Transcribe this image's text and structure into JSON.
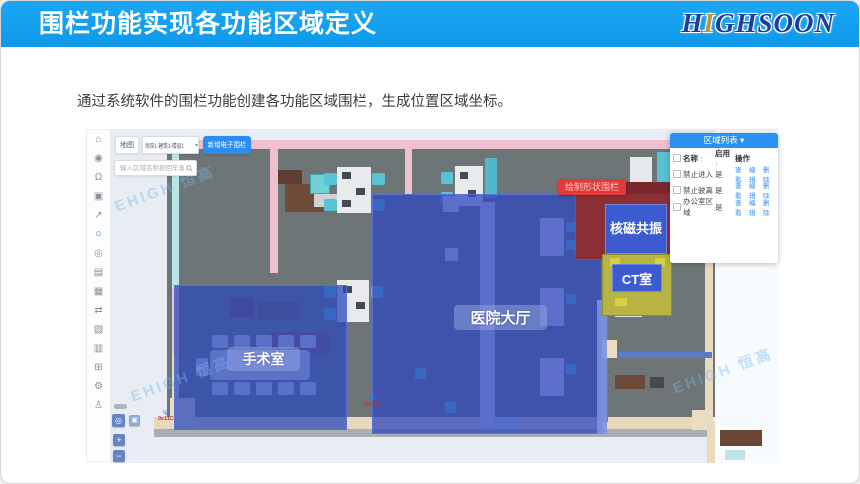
{
  "slide": {
    "title": "围栏功能实现各功能区域定义",
    "logo": {
      "part1": "H",
      "part2": "I",
      "part3": "GHSOON"
    },
    "body_text": "通过系统软件的围栏功能创建各功能区域围栏，生成位置区域坐标。"
  },
  "app": {
    "toolbar": {
      "map_label": "地图",
      "floor_selector": "场馆1-建筑1-楼层1",
      "caret": "▾",
      "add_fence_button": "新增电子围栏",
      "search_placeholder": "输入区域名称按回车查找"
    },
    "sidebar_icons": [
      {
        "name": "home-icon",
        "glyph": "⌂"
      },
      {
        "name": "eye-icon",
        "glyph": "◉"
      },
      {
        "name": "bell-icon",
        "glyph": "Ω"
      },
      {
        "name": "camera-icon",
        "glyph": "▣"
      },
      {
        "name": "send-icon",
        "glyph": "↗"
      },
      {
        "name": "fence-icon",
        "glyph": "○"
      },
      {
        "name": "location-icon",
        "glyph": "◎"
      },
      {
        "name": "list-icon",
        "glyph": "▤"
      },
      {
        "name": "calendar-icon",
        "glyph": "▦"
      },
      {
        "name": "route-icon",
        "glyph": "⇄"
      },
      {
        "name": "image-icon",
        "glyph": "▧"
      },
      {
        "name": "building-icon",
        "glyph": "▥"
      },
      {
        "name": "layout-icon",
        "glyph": "⊞"
      },
      {
        "name": "gear-icon",
        "glyph": "⚙"
      },
      {
        "name": "user-icon",
        "glyph": "♙"
      }
    ],
    "region_panel": {
      "title": "区域列表",
      "caret": "▾",
      "col_check": "",
      "col_name": "名称",
      "col_enabled": "启用",
      "col_ops": "操作",
      "sort_glyph": "↕",
      "rows": [
        {
          "name": "禁止进入",
          "enabled": "是"
        },
        {
          "name": "禁止驶离",
          "enabled": "是"
        },
        {
          "name": "办公室区域",
          "enabled": "是"
        }
      ],
      "ops": [
        "查看",
        "编辑",
        "删除"
      ]
    },
    "zones": {
      "operating_room": "手术室",
      "lobby": "医院大厅",
      "mri": "核磁共振",
      "ct": "CT室",
      "draw_tooltip": "绘制形状围栏"
    },
    "beacons": [
      "0x11",
      "0x11M",
      "0x11C"
    ],
    "beacon_glyph": "Ψ",
    "watermark": "EHIGH 恒高",
    "map_controls": {
      "locate": "◎",
      "layers": "▣",
      "zoom_in": "+",
      "zoom_out": "−"
    },
    "colors": {
      "banner_blue": "#129fec",
      "accent_blue": "#2b8df0",
      "zone_blue": "#3048be",
      "zone_olive": "#b6b544",
      "zone_maroon": "#8c2f35",
      "alert_red": "#e23a3a"
    }
  }
}
